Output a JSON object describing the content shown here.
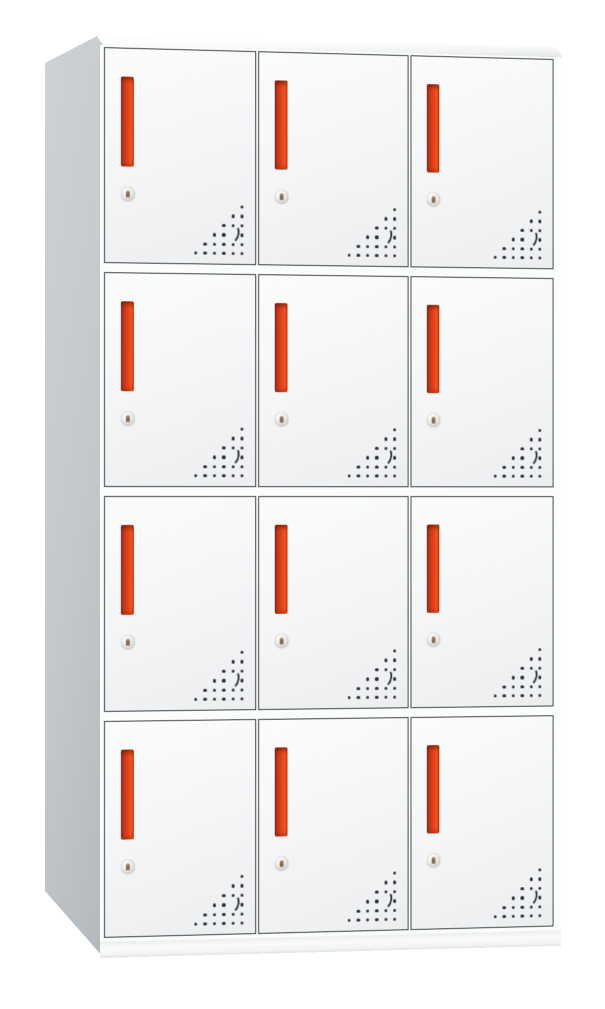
{
  "image": {
    "description": "Twelve-door white steel locker cabinet with red recessed handles, round keyhole locks and triangular ventilation perforations",
    "view": "front three-quarter product shot on plain white background"
  },
  "cabinet": {
    "rows": 4,
    "columns": 3,
    "door_count": 12,
    "door_features": [
      "red-handle",
      "keyhole-lock",
      "vent-holes"
    ]
  },
  "colors": {
    "background": "#ffffff",
    "frame": "#fbfcfc",
    "door_face": "#f5f6f7",
    "door_border": "#3e4245",
    "side_panel": "#c6cbce",
    "top_surface": "#f7f8f9",
    "handle_red": "#e04019",
    "handle_red_dark": "#8f2511",
    "handle_red_light": "#ef5c25",
    "lock_silver": "#d5d4d0",
    "lock_keyhole": "#6e5137",
    "vent_dot": "#2d3135"
  },
  "vent_pattern": {
    "grid_size": 6,
    "dot_rows": [
      [
        5
      ],
      [
        4,
        5
      ],
      [
        3,
        4,
        5
      ],
      [
        2,
        3,
        5
      ],
      [
        1,
        2,
        3,
        4,
        5
      ],
      [
        0,
        1,
        2,
        3,
        4,
        5
      ]
    ],
    "crescent_cell": {
      "row": 3,
      "col": 4
    }
  }
}
